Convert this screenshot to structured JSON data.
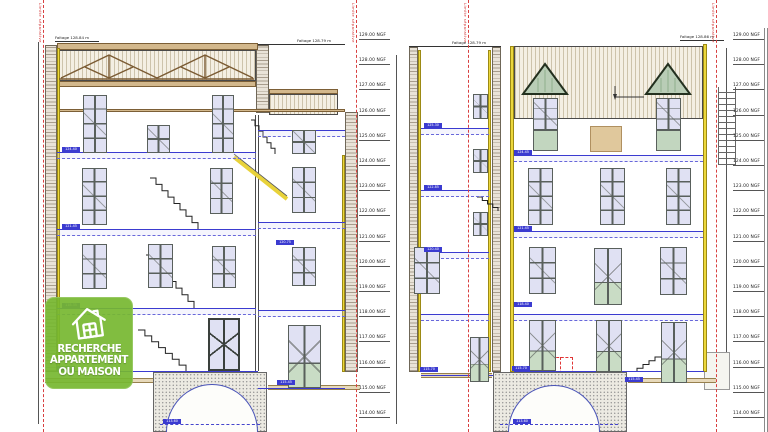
{
  "logo": {
    "line1": "RECHERCHE",
    "line2": "APPARTEMENT",
    "line3": "OU MAISON",
    "brand_color": "#76b730"
  },
  "boundary": {
    "label": "Limite séparative",
    "color": "#d03030",
    "xs": [
      43,
      356,
      468,
      716
    ]
  },
  "levels": {
    "middle_x": 359,
    "right_x": 733,
    "top_y": 33,
    "step": 25.2,
    "values": [
      "129.00 NGF",
      "128.00 NGF",
      "127.00 NGF",
      "126.00 NGF",
      "125.00 NGF",
      "124.00 NGF",
      "123.00 NGF",
      "122.00 NGF",
      "121.00 NGF",
      "120.00 NGF",
      "119.00 NGF",
      "118.00 NGF",
      "117.00 NGF",
      "116.00 NGF",
      "115.00 NGF",
      "114.00 NGF"
    ]
  },
  "faitage_labels": [
    {
      "text": "Faitage 128.84 m",
      "x": 55,
      "y": 36
    },
    {
      "text": "Faitage 128.79 m",
      "x": 297,
      "y": 39
    },
    {
      "text": "Faitage 128.79 m",
      "x": 452,
      "y": 41
    },
    {
      "text": "Faitage 128.86 m",
      "x": 680,
      "y": 35
    }
  ],
  "drawing": {
    "rects": [
      {
        "x": 45,
        "y": 45,
        "w": 12,
        "h": 327,
        "cls": "wallh",
        "name": "left-section-left-wall"
      },
      {
        "x": 57,
        "y": 48,
        "w": 3,
        "h": 324,
        "cls": "yellow",
        "name": "left-section-insulation-left"
      },
      {
        "x": 57,
        "y": 43,
        "w": 201,
        "h": 7,
        "cls": "tan",
        "name": "left-section-roof-slab"
      },
      {
        "x": 57,
        "y": 50,
        "w": 199,
        "h": 31,
        "cls": "roofhatch",
        "name": "left-section-attic-truss-zone"
      },
      {
        "x": 57,
        "y": 81,
        "w": 199,
        "h": 6,
        "cls": "tan",
        "name": "left-section-attic-beam"
      },
      {
        "x": 57,
        "y": 109,
        "w": 288,
        "h": 3,
        "cls": "tan",
        "name": "left-section-attic-floor-band"
      },
      {
        "x": 256,
        "y": 45,
        "w": 13,
        "h": 68,
        "cls": "wallh",
        "name": "left-section-chimney-wall"
      },
      {
        "x": 269,
        "y": 89,
        "w": 69,
        "h": 5,
        "cls": "tan",
        "name": "left-wing-roof-slab"
      },
      {
        "x": 269,
        "y": 94,
        "w": 69,
        "h": 21,
        "cls": "roofhatch",
        "name": "left-wing-roof-hatch"
      },
      {
        "x": 345,
        "y": 112,
        "w": 13,
        "h": 260,
        "cls": "wallh",
        "name": "left-section-right-wall"
      },
      {
        "x": 342,
        "y": 155,
        "w": 3,
        "h": 217,
        "cls": "yellow",
        "name": "left-section-insulation-right"
      },
      {
        "x": 255,
        "y": 115,
        "w": 4,
        "h": 256,
        "cls": "wall2",
        "name": "left-section-interior-wall"
      },
      {
        "x": 45,
        "y": 378,
        "w": 108,
        "h": 5,
        "cls": "terrain",
        "name": "terrain-left"
      },
      {
        "x": 268,
        "y": 385,
        "w": 92,
        "h": 5,
        "cls": "terrain",
        "name": "terrain-left-wing"
      },
      {
        "x": 153,
        "y": 372,
        "w": 114,
        "h": 60,
        "cls": "stipple",
        "name": "left-basement-mass"
      },
      {
        "x": 165,
        "y": 377,
        "w": 20,
        "h": 7,
        "cls": "vent",
        "name": "left-basement-vent-1"
      },
      {
        "x": 206,
        "y": 377,
        "w": 36,
        "h": 9,
        "cls": "vent",
        "name": "left-basement-vent-2"
      },
      {
        "x": 409,
        "y": 47,
        "w": 9,
        "h": 325,
        "cls": "wallh",
        "name": "right-wing-left-wall"
      },
      {
        "x": 418,
        "y": 50,
        "w": 3,
        "h": 322,
        "cls": "yellow",
        "name": "right-wing-insulation-left"
      },
      {
        "x": 492,
        "y": 47,
        "w": 9,
        "h": 325,
        "cls": "wallh",
        "name": "right-wing-right-wall"
      },
      {
        "x": 488,
        "y": 50,
        "w": 3,
        "h": 322,
        "cls": "yellow",
        "name": "right-wing-insulation-right"
      },
      {
        "x": 409,
        "y": 46,
        "w": 92,
        "h": 1,
        "cls": "hline",
        "name": "right-wing-roof-line"
      },
      {
        "x": 510,
        "y": 46,
        "w": 4,
        "h": 326,
        "cls": "yellow",
        "name": "facade-insulation-left"
      },
      {
        "x": 703,
        "y": 44,
        "w": 4,
        "h": 328,
        "cls": "yellow",
        "name": "facade-insulation-right"
      },
      {
        "x": 514,
        "y": 46,
        "w": 189,
        "h": 73,
        "cls": "roofhatch",
        "name": "facade-roof"
      },
      {
        "x": 527,
        "y": 92,
        "w": 36,
        "h": 7,
        "cls": "greenstripe",
        "name": "dormer-1-front"
      },
      {
        "x": 650,
        "y": 92,
        "w": 36,
        "h": 7,
        "cls": "greenstripe",
        "name": "dormer-2-front"
      },
      {
        "x": 533,
        "y": 130,
        "w": 25,
        "h": 21,
        "cls": "greenpanel",
        "name": "dormer-1-shutter"
      },
      {
        "x": 656,
        "y": 130,
        "w": 25,
        "h": 21,
        "cls": "greenpanel",
        "name": "dormer-2-shutter"
      },
      {
        "x": 590,
        "y": 126,
        "w": 32,
        "h": 26,
        "cls": "tanpatch",
        "name": "facade-repair-patch"
      },
      {
        "x": 421,
        "y": 373,
        "w": 71,
        "h": 5,
        "cls": "terrain",
        "name": "terrain-right-wing"
      },
      {
        "x": 628,
        "y": 378,
        "w": 88,
        "h": 5,
        "cls": "terrain",
        "name": "terrain-right"
      },
      {
        "x": 493,
        "y": 372,
        "w": 134,
        "h": 60,
        "cls": "stipple",
        "name": "right-basement-mass"
      },
      {
        "x": 704,
        "y": 352,
        "w": 26,
        "h": 38,
        "cls": "annex",
        "name": "right-annex-structure"
      },
      {
        "x": 718,
        "y": 87,
        "w": 18,
        "h": 78,
        "cls": "ladder",
        "name": "exterior-ladder"
      },
      {
        "x": 764,
        "y": 28,
        "w": 1,
        "h": 404,
        "cls": "vline",
        "name": "right-border-line-1"
      },
      {
        "x": 767,
        "y": 28,
        "w": 1,
        "h": 404,
        "cls": "vline",
        "name": "right-border-line-2"
      },
      {
        "x": 38,
        "y": 42,
        "w": 1,
        "h": 382,
        "cls": "dimline",
        "name": "dimension-line-left"
      },
      {
        "x": 396,
        "y": 55,
        "w": 1,
        "h": 369,
        "cls": "dimline",
        "name": "dimension-line-middle"
      },
      {
        "x": 726,
        "y": 48,
        "w": 1,
        "h": 324,
        "cls": "dimline",
        "name": "dimension-line-right"
      },
      {
        "x": 258,
        "y": 44,
        "w": 87,
        "h": 1,
        "cls": "hline",
        "name": "left-faitage-leader"
      },
      {
        "x": 547,
        "y": 357,
        "w": 26,
        "h": 26,
        "cls": "reddashbox",
        "name": "red-marker-box"
      },
      {
        "x": 560,
        "y": 357,
        "w": 0,
        "h": 26,
        "cls": "redvline",
        "name": "red-marker-divider"
      }
    ],
    "windows": [
      {
        "x": 83,
        "y": 95,
        "w": 24,
        "h": 58,
        "cls": "w8",
        "name": "left-attic-window-1"
      },
      {
        "x": 147,
        "y": 125,
        "w": 23,
        "h": 28,
        "cls": "w4",
        "name": "left-attic-window-2"
      },
      {
        "x": 212,
        "y": 95,
        "w": 22,
        "h": 58,
        "cls": "w8",
        "name": "left-attic-window-3"
      },
      {
        "x": 82,
        "y": 168,
        "w": 25,
        "h": 57,
        "cls": "w8",
        "name": "left-l2-window-1"
      },
      {
        "x": 210,
        "y": 168,
        "w": 23,
        "h": 46,
        "cls": "w6",
        "name": "left-l2-window-2"
      },
      {
        "x": 292,
        "y": 130,
        "w": 24,
        "h": 24,
        "cls": "w4",
        "name": "left-wing-window-1"
      },
      {
        "x": 292,
        "y": 167,
        "w": 24,
        "h": 46,
        "cls": "w6",
        "name": "left-wing-window-2"
      },
      {
        "x": 292,
        "y": 247,
        "w": 24,
        "h": 39,
        "cls": "w6",
        "name": "left-wing-window-3"
      },
      {
        "x": 82,
        "y": 244,
        "w": 25,
        "h": 45,
        "cls": "w6",
        "name": "left-l1-window-1"
      },
      {
        "x": 148,
        "y": 244,
        "w": 25,
        "h": 44,
        "cls": "w6",
        "name": "left-l1-window-2"
      },
      {
        "x": 212,
        "y": 246,
        "w": 24,
        "h": 42,
        "cls": "w6",
        "name": "left-l1-window-3"
      },
      {
        "x": 208,
        "y": 318,
        "w": 32,
        "h": 53,
        "cls": "dw",
        "name": "left-ground-french-door"
      },
      {
        "x": 288,
        "y": 325,
        "w": 33,
        "h": 63,
        "cls": "door",
        "name": "left-wing-ground-door"
      },
      {
        "x": 473,
        "y": 94,
        "w": 15,
        "h": 25,
        "cls": "w4",
        "name": "right-wing-window-1"
      },
      {
        "x": 473,
        "y": 149,
        "w": 15,
        "h": 24,
        "cls": "w4",
        "name": "right-wing-window-2"
      },
      {
        "x": 473,
        "y": 212,
        "w": 15,
        "h": 24,
        "cls": "w4",
        "name": "right-wing-window-3"
      },
      {
        "x": 414,
        "y": 247,
        "w": 26,
        "h": 47,
        "cls": "w6",
        "name": "right-wing-window-4"
      },
      {
        "x": 470,
        "y": 337,
        "w": 19,
        "h": 45,
        "cls": "door",
        "name": "right-wing-ground-door"
      },
      {
        "x": 533,
        "y": 98,
        "w": 25,
        "h": 32,
        "cls": "w6",
        "name": "dormer-1-window"
      },
      {
        "x": 656,
        "y": 98,
        "w": 25,
        "h": 32,
        "cls": "w6",
        "name": "dormer-2-window"
      },
      {
        "x": 528,
        "y": 168,
        "w": 25,
        "h": 57,
        "cls": "w8",
        "name": "facade-l2-window-1"
      },
      {
        "x": 600,
        "y": 168,
        "w": 25,
        "h": 57,
        "cls": "w8",
        "name": "facade-l2-window-2"
      },
      {
        "x": 666,
        "y": 168,
        "w": 25,
        "h": 57,
        "cls": "w8",
        "name": "facade-l2-window-3"
      },
      {
        "x": 529,
        "y": 247,
        "w": 27,
        "h": 47,
        "cls": "w6",
        "name": "facade-l1-window-1"
      },
      {
        "x": 594,
        "y": 248,
        "w": 28,
        "h": 57,
        "cls": "door",
        "name": "facade-l1-door"
      },
      {
        "x": 660,
        "y": 247,
        "w": 27,
        "h": 48,
        "cls": "w6",
        "name": "facade-l1-window-2"
      },
      {
        "x": 529,
        "y": 320,
        "w": 27,
        "h": 51,
        "cls": "door",
        "name": "facade-ground-door-1"
      },
      {
        "x": 596,
        "y": 320,
        "w": 26,
        "h": 52,
        "cls": "door",
        "name": "facade-ground-door-2"
      },
      {
        "x": 661,
        "y": 322,
        "w": 26,
        "h": 61,
        "cls": "door",
        "name": "facade-ground-door-3"
      }
    ],
    "floors": [
      {
        "x": 57,
        "y": 152,
        "w": 199
      },
      {
        "x": 57,
        "y": 229,
        "w": 199
      },
      {
        "x": 57,
        "y": 308,
        "w": 199
      },
      {
        "x": 258,
        "y": 130,
        "w": 87
      },
      {
        "x": 258,
        "y": 222,
        "w": 87
      },
      {
        "x": 258,
        "y": 310,
        "w": 87
      },
      {
        "x": 421,
        "y": 128,
        "w": 68
      },
      {
        "x": 421,
        "y": 190,
        "w": 68
      },
      {
        "x": 421,
        "y": 252,
        "w": 68
      },
      {
        "x": 421,
        "y": 314,
        "w": 68
      },
      {
        "x": 514,
        "y": 155,
        "w": 189
      },
      {
        "x": 514,
        "y": 231,
        "w": 189
      },
      {
        "x": 514,
        "y": 314,
        "w": 189
      }
    ],
    "ground_lines": [
      {
        "x": 57,
        "y": 371,
        "w": 201
      },
      {
        "x": 258,
        "y": 388,
        "w": 87
      },
      {
        "x": 421,
        "y": 375,
        "w": 72
      },
      {
        "x": 514,
        "y": 371,
        "w": 190
      }
    ],
    "arches": [
      {
        "x": 166,
        "y": 384,
        "w": 92,
        "h": 48,
        "name": "left-basement-vault"
      },
      {
        "x": 508,
        "y": 385,
        "w": 92,
        "h": 47,
        "name": "right-basement-vault"
      }
    ],
    "bdash": [
      {
        "x": 160,
        "y": 424,
        "w": 100
      },
      {
        "x": 500,
        "y": 424,
        "w": 118
      }
    ],
    "level_boxes": [
      {
        "x": 62,
        "y": 147,
        "text": "124.40"
      },
      {
        "x": 62,
        "y": 224,
        "text": "121.45"
      },
      {
        "x": 62,
        "y": 303,
        "text": "118.35"
      },
      {
        "x": 57,
        "y": 366,
        "text": "115.70"
      },
      {
        "x": 276,
        "y": 240,
        "text": "120.75"
      },
      {
        "x": 277,
        "y": 380,
        "text": "115.45"
      },
      {
        "x": 163,
        "y": 419,
        "text": "113.60"
      },
      {
        "x": 424,
        "y": 123,
        "text": "125.30"
      },
      {
        "x": 424,
        "y": 185,
        "text": "122.85"
      },
      {
        "x": 424,
        "y": 247,
        "text": "120.40"
      },
      {
        "x": 420,
        "y": 367,
        "text": "115.70"
      },
      {
        "x": 514,
        "y": 150,
        "text": "124.45"
      },
      {
        "x": 514,
        "y": 226,
        "text": "121.45"
      },
      {
        "x": 514,
        "y": 302,
        "text": "118.40"
      },
      {
        "x": 512,
        "y": 366,
        "text": "115.70"
      },
      {
        "x": 513,
        "y": 419,
        "text": "113.60"
      },
      {
        "x": 625,
        "y": 377,
        "text": "115.45"
      }
    ],
    "stairs": [
      {
        "x": 138,
        "y": 330,
        "w": 48,
        "h": 41,
        "n": 7,
        "dir": "lu"
      },
      {
        "x": 146,
        "y": 255,
        "w": 48,
        "h": 53,
        "n": 8,
        "dir": "lu"
      },
      {
        "x": 150,
        "y": 178,
        "w": 48,
        "h": 51,
        "n": 8,
        "dir": "lu"
      },
      {
        "x": 251,
        "y": 120,
        "w": 24,
        "h": 34,
        "n": 6,
        "dir": "lu"
      },
      {
        "x": 477,
        "y": 197,
        "w": 21,
        "h": 14,
        "n": 4,
        "dir": "lu"
      },
      {
        "x": 637,
        "y": 357,
        "w": 24,
        "h": 15,
        "n": 4,
        "dir": "ru"
      }
    ],
    "stringer": {
      "x1": 234,
      "y1": 157,
      "x2": 287,
      "y2": 199
    }
  }
}
